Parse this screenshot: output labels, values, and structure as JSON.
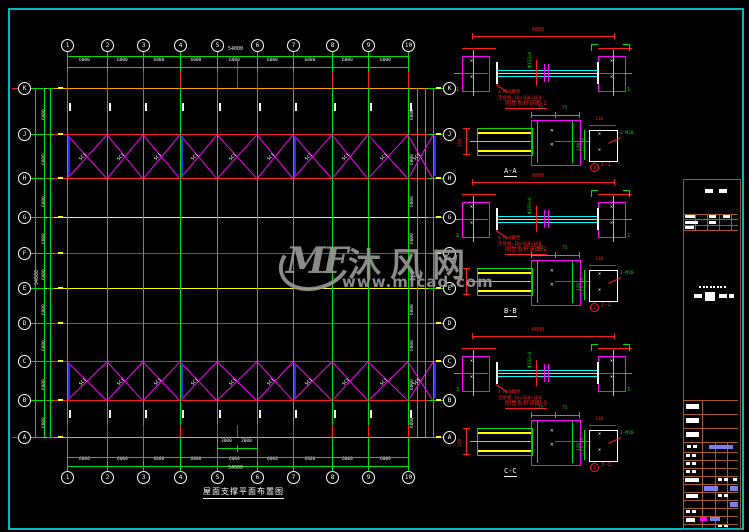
{
  "watermark": {
    "logo": "MF",
    "brand": "沐风网",
    "url": "www.mfcad.com"
  },
  "plan": {
    "title": "屋面支撑平面布置图",
    "columns": [
      {
        "label": "1",
        "x": 67
      },
      {
        "label": "2",
        "x": 107
      },
      {
        "label": "3",
        "x": 143
      },
      {
        "label": "4",
        "x": 180
      },
      {
        "label": "5",
        "x": 217
      },
      {
        "label": "6",
        "x": 257
      },
      {
        "label": "7",
        "x": 293
      },
      {
        "label": "8",
        "x": 332
      },
      {
        "label": "9",
        "x": 368
      },
      {
        "label": "10",
        "x": 408
      }
    ],
    "rows": [
      {
        "label": "K",
        "y": 88,
        "line": "orange"
      },
      {
        "label": "J",
        "y": 134,
        "line": "red"
      },
      {
        "label": "H",
        "y": 178,
        "line": "red"
      },
      {
        "label": "G",
        "y": 217,
        "line": "yellow"
      },
      {
        "label": "F",
        "y": 253,
        "line": "red"
      },
      {
        "label": "E",
        "y": 288,
        "line": "yellow"
      },
      {
        "label": "D",
        "y": 323,
        "line": "red"
      },
      {
        "label": "C",
        "y": 361,
        "line": "red"
      },
      {
        "label": "B",
        "y": 400,
        "line": "red"
      },
      {
        "label": "A",
        "y": 437,
        "line": "orange"
      }
    ],
    "bay_dim": "6000",
    "total_dim": "54000",
    "mid_dims": [
      "3000",
      "3000"
    ],
    "row_bay_dim": "6000",
    "row_total_dim": "54000",
    "brace_label": "SC1",
    "brace_bands": [
      {
        "top": 134,
        "bottom": 178
      },
      {
        "top": 361,
        "bottom": 400
      }
    ],
    "blue_brace_x": [
      67,
      180,
      293,
      433
    ]
  },
  "details": {
    "tierods": [
      {
        "y": 40,
        "title": "刚性系杆详图-1",
        "total": "6000",
        "pipe": "Φ133×4",
        "note1": "4-M20螺栓",
        "note2": "连接板-10×160×160",
        "cut": "1"
      },
      {
        "y": 186,
        "title": "刚性系杆详图-2",
        "total": "6000",
        "pipe": "Φ133×4",
        "note1": "4-M20螺栓",
        "note2": "连接板-10×160×160",
        "cut": "2"
      },
      {
        "y": 340,
        "title": "刚性系杆详图-3",
        "total": "6000",
        "pipe": "Φ133×4",
        "note1": "4-M20螺栓",
        "note2": "连接板-10×160×160",
        "cut": "3"
      }
    ],
    "sections": [
      {
        "y": 117,
        "label": "A-A",
        "plate": "1-1",
        "bolt": "3-M20",
        "dim_v": "150",
        "top_dims": [
          "75",
          "75"
        ],
        "plate_w": "110",
        "plate_h": "120",
        "side_note": "PL-10"
      },
      {
        "y": 257,
        "label": "B-B",
        "plate": "2-2",
        "bolt": "2-M20",
        "dim_v": "150",
        "top_dims": [
          "75",
          "75"
        ],
        "plate_w": "110",
        "plate_h": "120",
        "side_note": "PL-10"
      },
      {
        "y": 417,
        "label": "C-C",
        "plate": "3-3",
        "bolt": "2-M20",
        "dim_v": "150",
        "top_dims": [
          "75",
          "75"
        ],
        "plate_w": "110",
        "plate_h": "120",
        "side_note": "PL-10"
      }
    ]
  },
  "colors": {
    "frame": "#00b8c8",
    "green": "#00dd00",
    "red": "#ff1e1e",
    "orange": "#ffa500",
    "yellow": "#ffff00",
    "magenta": "#ff00ff",
    "cyan": "#00ffff",
    "blue": "#2a2aff",
    "white": "#e8e8e8",
    "titleblock": "#a8581c",
    "highlight": "#7d7df0",
    "gray": "#9a9a9a"
  }
}
